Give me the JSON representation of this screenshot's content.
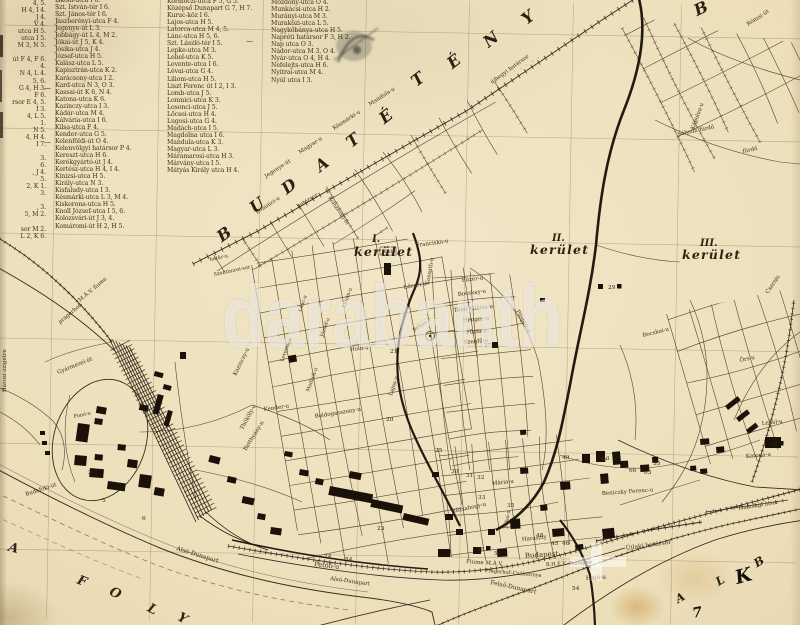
{
  "watermark": {
    "text": "darabanth"
  },
  "colors": {
    "paper": "#ecdfba",
    "ink": "#33281a",
    "buildings": "#1a1209",
    "watermark_white": "rgba(255,255,255,0.53)"
  },
  "index": {
    "columns": [
      {
        "id": "col1",
        "left": 0,
        "top": 0,
        "width": 46,
        "align": "right",
        "entries": [
          "4, 5.",
          "H 4, I 4.",
          "J 4.",
          "V 4.",
          "utca H 5.",
          "utca I 5.",
          "M 3, N 5.",
          "",
          "út F 4, F 6.",
          "4.",
          "N 4, L 4.",
          "5, 6.",
          "G 4, H 3.",
          "F 6.",
          "rsor E 4, 5.",
          "I 3.",
          "4, L 5.",
          "1.",
          "N 5.",
          "4, H 4.",
          "I 7.",
          "",
          "3.",
          "6.",
          ", J 4.",
          "5.",
          "2, K 1.",
          "3.",
          "",
          ", 3.",
          "5, M 2.",
          "",
          "sor M 2.",
          "L 2, K 6."
        ]
      },
      {
        "id": "col2",
        "left": 55,
        "top": -3,
        "width": 110,
        "align": "left",
        "entries": [
          "Iskola-utca I 6.",
          "Szt. István-tér I 6.",
          "Szt. János-tér I 6.",
          "Jászberényi-utca F 4.",
          "Jegenye-út L 3.",
          "Jobbágy-út L 4, M 2.",
          "Jókai-út J 5, K 4.",
          "Jósika-utca J 4.",
          "József-utca H 5.",
          "Kalász-utca L 5.",
          "Kapisztrán-utca K 2.",
          "Karácsony-utca I 2.",
          "Kard-utca N 3, O 3.",
          "Kassai-út K 6, N 4.",
          "Katona-utca K 6.",
          "Kazinczy-utca I 3.",
          "Kádár-utca M 4.",
          "Kálvária-utca I 6.",
          "Kilsa-utca F 4.",
          "Kender-utca G 5.",
          "Kelenföldi-út O 4.",
          "Kelenvölgyi határsor P 4.",
          "Kereszt-utca H 6.",
          "Kerékgyártó-út J 4.",
          "Kertész-utca H 4, I 4.",
          "Kinizsi-utca H 5.",
          "Király-utca N 3.",
          "Kisfaludy-utca I 3.",
          "Késmárki-utca L 3, M 4.",
          "Kiskorona-utca H 5.",
          "Knoll József-utca I 5, 6.",
          "Kolozsvári-út J 3, 4.",
          "Komáromi-út H 2, H 5."
        ]
      },
      {
        "id": "col3",
        "left": 167,
        "top": -2,
        "width": 105,
        "align": "left",
        "entries": [
          "Körmöczi-utca F 5, G 5.",
          "Középső Dunapart G 7, H 7.",
          "Kuruc-köz I 6.",
          "Lajos-utca H 5.",
          "Latorca-utca M 4, 5.",
          "Lánc-utca H 5, 6.",
          "Szt. László-tér I 5.",
          "Lepke-utca M 3.",
          "Lehel-utca K 5.",
          "Levente-utca I 6.",
          "Lévai-utca G 4.",
          "Liliom-utca H 5.",
          "Liszt Ferenc út I 2, I 3.",
          "Lomb-utca J 5.",
          "Lomnici-utca K 3.",
          "Losonci-utca J 5.",
          "Lőcsei-utca H 4.",
          "Lugosi-utca G 4.",
          "Madách-utca I 5.",
          "Magdolna utca I 6.",
          "Mandula-utca K 3.",
          "Magyar-utca L 3.",
          "Máramarosi-utca H 3.",
          "Márvány-utca I 5.",
          "Mátyás Király utca H 4."
        ]
      },
      {
        "id": "col4",
        "left": 271,
        "top": -1,
        "width": 100,
        "align": "left",
        "entries": [
          "Mozdony-utca O 4.",
          "Munkácsi-utca H 2.",
          "Murányi-utca M 3.",
          "Muraközi-utca L 5.",
          "Nagykőbánya-utca H 5.",
          "Napréti határsor F 3, H 2.",
          "Nap utca O 3.",
          "Nádor-utca M 3, O 4.",
          "Nyár-utca O 4, H 4.",
          "Nefelejts-utca H 6.",
          "Nyitrai-utca M 4.",
          "Nyúl utca I 3."
        ]
      }
    ]
  },
  "districts": [
    {
      "numeral": "I.",
      "word": "kerület",
      "nx": 372,
      "ny": 242,
      "wx": 354,
      "wy": 256
    },
    {
      "numeral": "II.",
      "word": "kerület",
      "nx": 552,
      "ny": 241,
      "wx": 530,
      "wy": 254
    },
    {
      "numeral": "III.",
      "word": "kerület",
      "nx": 700,
      "ny": 246,
      "wx": 682,
      "wy": 259
    }
  ],
  "big_letters": [
    {
      "t": "B",
      "x": 228,
      "y": 238,
      "r": -36
    },
    {
      "t": "U",
      "x": 261,
      "y": 209,
      "r": -36
    },
    {
      "t": "D",
      "x": 293,
      "y": 190,
      "r": -38
    },
    {
      "t": "A",
      "x": 326,
      "y": 168,
      "r": -38
    },
    {
      "t": "T",
      "x": 357,
      "y": 144,
      "r": -38
    },
    {
      "t": "É",
      "x": 390,
      "y": 120,
      "r": -38
    },
    {
      "t": "T",
      "x": 422,
      "y": 83,
      "r": -38
    },
    {
      "t": "É",
      "x": 458,
      "y": 65,
      "r": -38
    },
    {
      "t": "N",
      "x": 495,
      "y": 43,
      "r": -38
    },
    {
      "t": "Y",
      "x": 532,
      "y": 21,
      "r": -38
    },
    {
      "t": "B",
      "x": 704,
      "y": 13,
      "r": -25
    }
  ],
  "shore_letters": [
    {
      "t": "A",
      "x": 13,
      "y": 552,
      "r": 15
    },
    {
      "t": "F",
      "x": 81,
      "y": 585,
      "r": 22
    },
    {
      "t": "O",
      "x": 114,
      "y": 597,
      "r": 26
    },
    {
      "t": "L",
      "x": 151,
      "y": 613,
      "r": 28
    },
    {
      "t": "Y",
      "x": 181,
      "y": 622,
      "r": 30
    }
  ],
  "corner_letters": [
    {
      "t": "A",
      "x": 682,
      "y": 601,
      "r": -30
    },
    {
      "t": "L",
      "x": 722,
      "y": 584,
      "r": -30
    },
    {
      "t": "B",
      "x": 761,
      "y": 565,
      "r": -32
    }
  ],
  "pen_marks": [
    {
      "t": "K",
      "x": 745,
      "y": 582,
      "r": -15,
      "cls": "pen"
    },
    {
      "t": "7",
      "x": 698,
      "y": 617,
      "r": -10,
      "cls": "pen2"
    }
  ],
  "street_labels": [
    {
      "t": "határsor",
      "x": 298,
      "y": 208,
      "r": -31,
      "s": 5.5
    },
    {
      "t": "újhegyi határsor",
      "x": 492,
      "y": 84,
      "r": -36,
      "s": 5.5
    },
    {
      "t": "Gyármezei-út",
      "x": 58,
      "y": 374,
      "r": -22,
      "s": 5.5
    },
    {
      "t": "M.Á.V. fiume",
      "x": 80,
      "y": 302,
      "r": -40,
      "s": 5.5
    },
    {
      "t": "pragerhof",
      "x": 60,
      "y": 324,
      "r": -40,
      "s": 5.5
    },
    {
      "t": "Hárosi-szigetre",
      "x": 6,
      "y": 392,
      "r": -90,
      "s": 5.5
    },
    {
      "t": "Budafoki-út",
      "x": 26,
      "y": 496,
      "r": -18,
      "s": 5.5
    },
    {
      "t": "Fonó-u",
      "x": 74,
      "y": 418,
      "r": -12,
      "s": 5
    },
    {
      "t": "Alsó-Dunapart",
      "x": 176,
      "y": 550,
      "r": 17,
      "s": 6
    },
    {
      "t": "Alsó-Dunapart",
      "x": 330,
      "y": 580,
      "r": 8,
      "s": 5.5
    },
    {
      "t": "Petőfi-u",
      "x": 314,
      "y": 566,
      "r": 7,
      "s": 6.5
    },
    {
      "t": "Felső-Dunapart",
      "x": 490,
      "y": 584,
      "r": 12,
      "s": 6
    },
    {
      "t": "Hajó-u",
      "x": 586,
      "y": 580,
      "r": -4,
      "s": 6
    },
    {
      "t": "Budapest",
      "x": 525,
      "y": 558,
      "r": -4,
      "s": 7
    },
    {
      "t": "Fiume M.Á.V.",
      "x": 466,
      "y": 563,
      "r": 4,
      "s": 5.5
    },
    {
      "t": "Pragerhof–Csáktornya",
      "x": 485,
      "y": 572,
      "r": 5,
      "s": 5
    },
    {
      "t": "B.H.É.V.–Budapest",
      "x": 546,
      "y": 566,
      "r": -3,
      "s": 5
    },
    {
      "t": "Beniczky Ferenc-u",
      "x": 602,
      "y": 495,
      "r": -4,
      "s": 5.5
    },
    {
      "t": "Újlaki határsor",
      "x": 626,
      "y": 550,
      "r": -8,
      "s": 6
    },
    {
      "t": "Thansági h.sor",
      "x": 738,
      "y": 510,
      "r": -9,
      "s": 5.5
    },
    {
      "t": "Katona-u",
      "x": 746,
      "y": 458,
      "r": -5,
      "s": 5.5
    },
    {
      "t": "Lehel-u",
      "x": 762,
      "y": 425,
      "r": -6,
      "s": 5.5
    },
    {
      "t": "Bocskai-u",
      "x": 643,
      "y": 337,
      "r": -14,
      "s": 5.5
    },
    {
      "t": "Örs-u",
      "x": 740,
      "y": 362,
      "r": -12,
      "s": 5.5
    },
    {
      "t": "Csertés",
      "x": 768,
      "y": 294,
      "r": -55,
      "s": 5.5
    },
    {
      "t": "Sólyom fürdő",
      "x": 678,
      "y": 136,
      "r": -12,
      "s": 5.5
    },
    {
      "t": "fürdő",
      "x": 743,
      "y": 153,
      "r": -12,
      "s": 5.5
    },
    {
      "t": "Kápolna-u",
      "x": 694,
      "y": 130,
      "r": -70,
      "s": 5.5
    },
    {
      "t": "Római-út",
      "x": 748,
      "y": 26,
      "r": -33,
      "s": 5.5
    },
    {
      "t": "Erdő",
      "x": 383,
      "y": 253,
      "r": 0,
      "s": 5
    },
    {
      "t": "Franciska-u",
      "x": 416,
      "y": 247,
      "r": -8,
      "s": 5.5
    },
    {
      "t": "Füzér-u",
      "x": 462,
      "y": 282,
      "r": -7,
      "s": 5.5
    },
    {
      "t": "Bocskay-u",
      "x": 458,
      "y": 296,
      "r": -7,
      "s": 5.5
    },
    {
      "t": "Toldi Miklós-u",
      "x": 454,
      "y": 312,
      "r": -6,
      "s": 5.5
    },
    {
      "t": "Henger-u",
      "x": 463,
      "y": 322,
      "r": -5,
      "s": 5.5
    },
    {
      "t": "Püspök-u",
      "x": 516,
      "y": 311,
      "r": 62,
      "s": 5.5
    },
    {
      "t": "Fűzfa-u",
      "x": 466,
      "y": 334,
      "r": -5,
      "s": 5.5
    },
    {
      "t": "Szegfű-u",
      "x": 464,
      "y": 344,
      "r": -5,
      "s": 5.5
    },
    {
      "t": "Kossuth-u",
      "x": 429,
      "y": 285,
      "r": -80,
      "s": 5.5
    },
    {
      "t": "Lőcsei-u",
      "x": 404,
      "y": 289,
      "r": -10,
      "s": 5.5
    },
    {
      "t": "Bohus-u",
      "x": 414,
      "y": 332,
      "r": -35,
      "s": 5
    },
    {
      "t": "Hold-u",
      "x": 350,
      "y": 351,
      "r": -6,
      "s": 5.5
    },
    {
      "t": "Lajos-u",
      "x": 392,
      "y": 396,
      "r": -72,
      "s": 5.5
    },
    {
      "t": "Kender-u",
      "x": 264,
      "y": 411,
      "r": -8,
      "s": 5.5
    },
    {
      "t": "Boldogasszony-u",
      "x": 315,
      "y": 418,
      "r": -9,
      "s": 5.5
    },
    {
      "t": "Thököly-u",
      "x": 243,
      "y": 430,
      "r": -62,
      "s": 5.5
    },
    {
      "t": "Batthyány-u",
      "x": 246,
      "y": 451,
      "r": -58,
      "s": 5.5
    },
    {
      "t": "Kazinczy-u",
      "x": 236,
      "y": 376,
      "r": -64,
      "s": 5.5
    },
    {
      "t": "Lánc-u",
      "x": 301,
      "y": 312,
      "r": -70,
      "s": 5
    },
    {
      "t": "József-u",
      "x": 323,
      "y": 337,
      "r": -70,
      "s": 5
    },
    {
      "t": "Liliom-u",
      "x": 345,
      "y": 308,
      "r": -70,
      "s": 5
    },
    {
      "t": "Levente-u",
      "x": 283,
      "y": 362,
      "r": -70,
      "s": 5
    },
    {
      "t": "Madách-u",
      "x": 309,
      "y": 392,
      "r": -70,
      "s": 5
    },
    {
      "t": "Rózsahegy-u",
      "x": 452,
      "y": 513,
      "r": -12,
      "s": 5.5
    },
    {
      "t": "Mária-u",
      "x": 492,
      "y": 485,
      "r": -6,
      "s": 5.5
    },
    {
      "t": "Jókai-u",
      "x": 507,
      "y": 528,
      "r": -80,
      "s": 5
    },
    {
      "t": "Haraszty",
      "x": 522,
      "y": 541,
      "r": -6,
      "s": 5.5
    },
    {
      "t": "Jegenye-út",
      "x": 266,
      "y": 178,
      "r": -33,
      "s": 5.5
    },
    {
      "t": "Magyar-u",
      "x": 300,
      "y": 154,
      "r": -33,
      "s": 5.5
    },
    {
      "t": "Késmárki-u",
      "x": 334,
      "y": 130,
      "r": -33,
      "s": 5.5
    },
    {
      "t": "Mandula-u",
      "x": 370,
      "y": 106,
      "r": -33,
      "s": 5.5
    },
    {
      "t": "Lomnici-u",
      "x": 257,
      "y": 214,
      "r": -33,
      "s": 5.5
    },
    {
      "t": "Kolozsvári-út",
      "x": 328,
      "y": 198,
      "r": 55,
      "s": 5
    },
    {
      "t": "határ-u.",
      "x": 210,
      "y": 261,
      "r": -12,
      "s": 5
    },
    {
      "t": "Szentimrei-sor",
      "x": 214,
      "y": 276,
      "r": -12,
      "s": 5
    },
    {
      "t": "—",
      "x": 44,
      "y": 90,
      "r": 0,
      "s": 7
    },
    {
      "t": "—",
      "x": 246,
      "y": 43,
      "r": 0,
      "s": 7
    },
    {
      "t": "—",
      "x": 44,
      "y": 144,
      "r": 0,
      "s": 7
    }
  ],
  "numbers": [
    {
      "n": "29",
      "x": 608,
      "y": 289,
      "sq": true
    },
    {
      "n": "21",
      "x": 390,
      "y": 353,
      "sq": false
    },
    {
      "n": "20",
      "x": 386,
      "y": 421,
      "sq": false
    },
    {
      "n": "27",
      "x": 484,
      "y": 347,
      "sq": true
    },
    {
      "n": "23",
      "x": 377,
      "y": 530,
      "sq": false
    },
    {
      "n": "24",
      "x": 324,
      "y": 558,
      "sq": false
    },
    {
      "n": "25",
      "x": 435,
      "y": 452,
      "sq": false
    },
    {
      "n": "30",
      "x": 451,
      "y": 473,
      "sq": false
    },
    {
      "n": "31",
      "x": 466,
      "y": 477,
      "sq": false
    },
    {
      "n": "32",
      "x": 477,
      "y": 479,
      "sq": false
    },
    {
      "n": "33",
      "x": 478,
      "y": 499,
      "sq": false
    },
    {
      "n": "35",
      "x": 507,
      "y": 507,
      "sq": false
    },
    {
      "n": "38",
      "x": 477,
      "y": 551,
      "sq": true
    },
    {
      "n": "58",
      "x": 494,
      "y": 555,
      "sq": false
    },
    {
      "n": "54",
      "x": 345,
      "y": 561,
      "sq": false
    },
    {
      "n": "54",
      "x": 572,
      "y": 590,
      "sq": false
    },
    {
      "n": "45",
      "x": 551,
      "y": 545,
      "sq": false
    },
    {
      "n": "46",
      "x": 562,
      "y": 545,
      "sq": false
    },
    {
      "n": "48",
      "x": 536,
      "y": 537,
      "sq": false
    },
    {
      "n": "43",
      "x": 602,
      "y": 460,
      "sq": false
    },
    {
      "n": "49",
      "x": 562,
      "y": 459,
      "sq": false
    },
    {
      "n": "57",
      "x": 600,
      "y": 462,
      "sq": false
    },
    {
      "n": "55",
      "x": 653,
      "y": 465,
      "sq": false
    },
    {
      "n": "66",
      "x": 629,
      "y": 472,
      "sq": false
    },
    {
      "n": "63",
      "x": 644,
      "y": 474,
      "sq": false
    },
    {
      "n": "12",
      "x": 770,
      "y": 446,
      "sq": true
    },
    {
      "n": "5",
      "x": 102,
      "y": 502,
      "sq": false
    },
    {
      "n": "6",
      "x": 142,
      "y": 520,
      "sq": false
    },
    {
      "n": "2",
      "x": 88,
      "y": 474,
      "sq": false
    }
  ]
}
